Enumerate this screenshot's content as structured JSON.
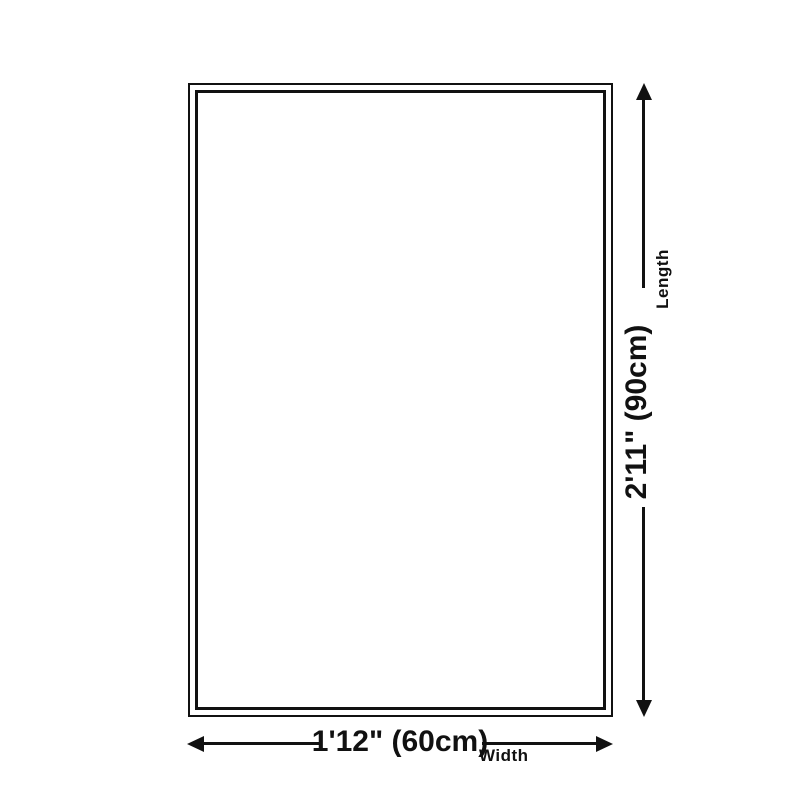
{
  "diagram": {
    "title": "product-size-diagram",
    "background_color": "#ffffff",
    "line_color": "#111111",
    "length": {
      "value": "2'11\" (90cm)",
      "label": "Length"
    },
    "width": {
      "value": "1'12\" (60cm)",
      "label": "Width"
    }
  }
}
